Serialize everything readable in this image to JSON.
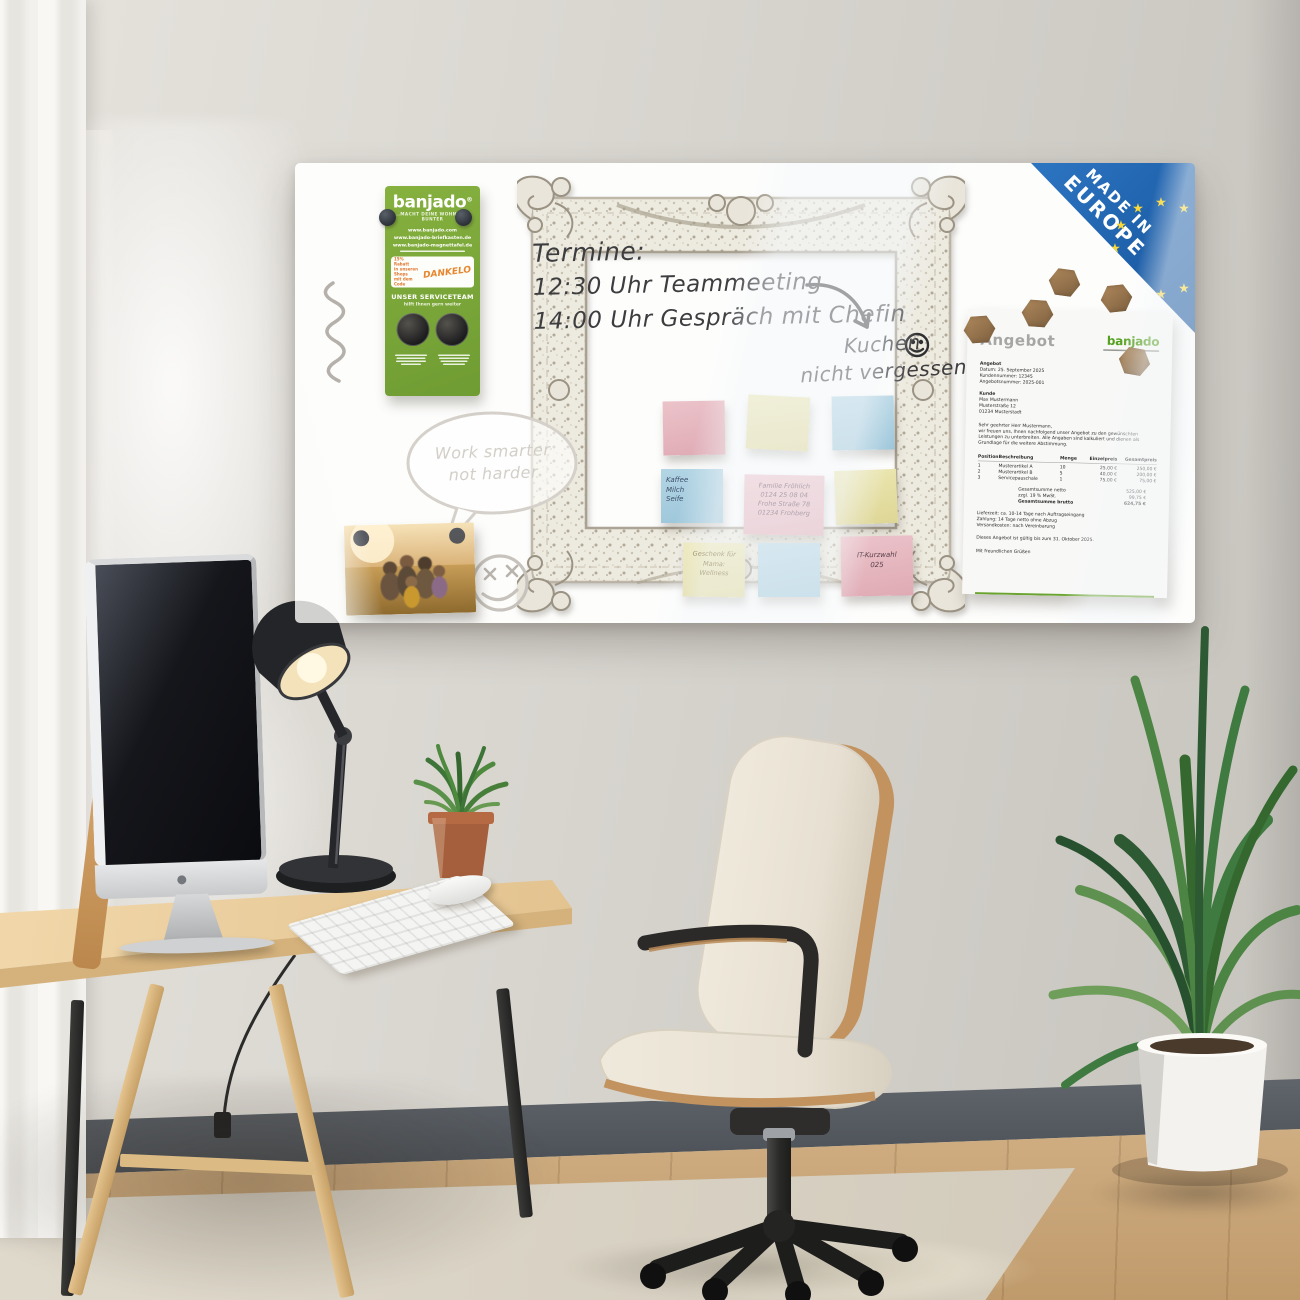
{
  "icons": {
    "eu_star": "★"
  },
  "board": {
    "badge": {
      "line1": "MADE IN",
      "line2": "EUROPE"
    },
    "flyer": {
      "brand": "banjado",
      "reg": "®",
      "tagline": "...MACHT DEINE WOHNWELT BUNTER",
      "urls": [
        "www.banjado.com",
        "www.banjado-briefkasten.de",
        "www.banjado-magnettafel.de"
      ],
      "coupon": {
        "l1": "15% Rabatt",
        "l2": "in unseren Shops",
        "l3": "mit dem Code",
        "code": "DANKELO"
      },
      "service": {
        "title": "UNSER SERVICETEAM",
        "subtitle": "hilft Ihnen gern weiter"
      }
    },
    "handwriting": {
      "termine": [
        "Termine:",
        "12:30 Uhr Teammeeting",
        "14:00 Uhr Gespräch mit Chefin"
      ],
      "kuchen": [
        "Kuchen",
        "nicht vergessen"
      ],
      "bubble": [
        "Work smarter",
        "not harder"
      ]
    },
    "notes": {
      "shopping": [
        "Kaffee",
        "Milch",
        "Seife"
      ],
      "address": [
        "Familie Fröhlich",
        "0124 25 08 04",
        "Frohe Straße 78",
        "01234 Frohberg"
      ],
      "gift": [
        "Geschenk für",
        "Mama:",
        "Wellness"
      ],
      "it": [
        "IT-Kurzwahl",
        "025"
      ]
    },
    "document": {
      "title": "Angebot",
      "logo": "banjado",
      "meta": [
        "Angebot",
        "Datum: 25. September 2025",
        "Kundennummer: 12345",
        "Angebotsnummer: 2025-001"
      ],
      "customer": [
        "Kunde",
        "Max Mustermann",
        "Musterstraße 12",
        "01234 Musterstadt"
      ],
      "salutation": "Sehr geehrter Herr Mustermann,",
      "intro": "wir freuen uns, Ihnen nachfolgend unser Angebot zu den gewünschten Leistungen zu unterbreiten. Alle Angaben sind kalkuliert und dienen als Grundlage für die weitere Abstimmung.",
      "table": {
        "headers": [
          "Position",
          "Beschreibung",
          "Menge",
          "Einzelpreis",
          "Gesamtpreis"
        ],
        "rows": [
          [
            "1",
            "Musterartikel A",
            "10",
            "25,00 €",
            "250,00 €"
          ],
          [
            "2",
            "Musterartikel B",
            "5",
            "40,00 €",
            "200,00 €"
          ],
          [
            "3",
            "Servicepauschale",
            "1",
            "75,00 €",
            "75,00 €"
          ]
        ]
      },
      "totals": [
        [
          "Gesamtsumme netto",
          "525,00 €"
        ],
        [
          "zzgl. 19 % MwSt.",
          "99,75 €"
        ],
        [
          "Gesamtsumme brutto",
          "624,75 €"
        ]
      ],
      "terms": [
        "Lieferzeit: ca. 10-14 Tage nach Auftragseingang",
        "Zahlung: 14 Tage netto ohne Abzug",
        "Versandkosten: nach Vereinbarung"
      ],
      "validity": "Dieses Angebot ist gültig bis zum 31. Oktober 2025.",
      "closing": "Mit freundlichen Grüßen"
    }
  }
}
